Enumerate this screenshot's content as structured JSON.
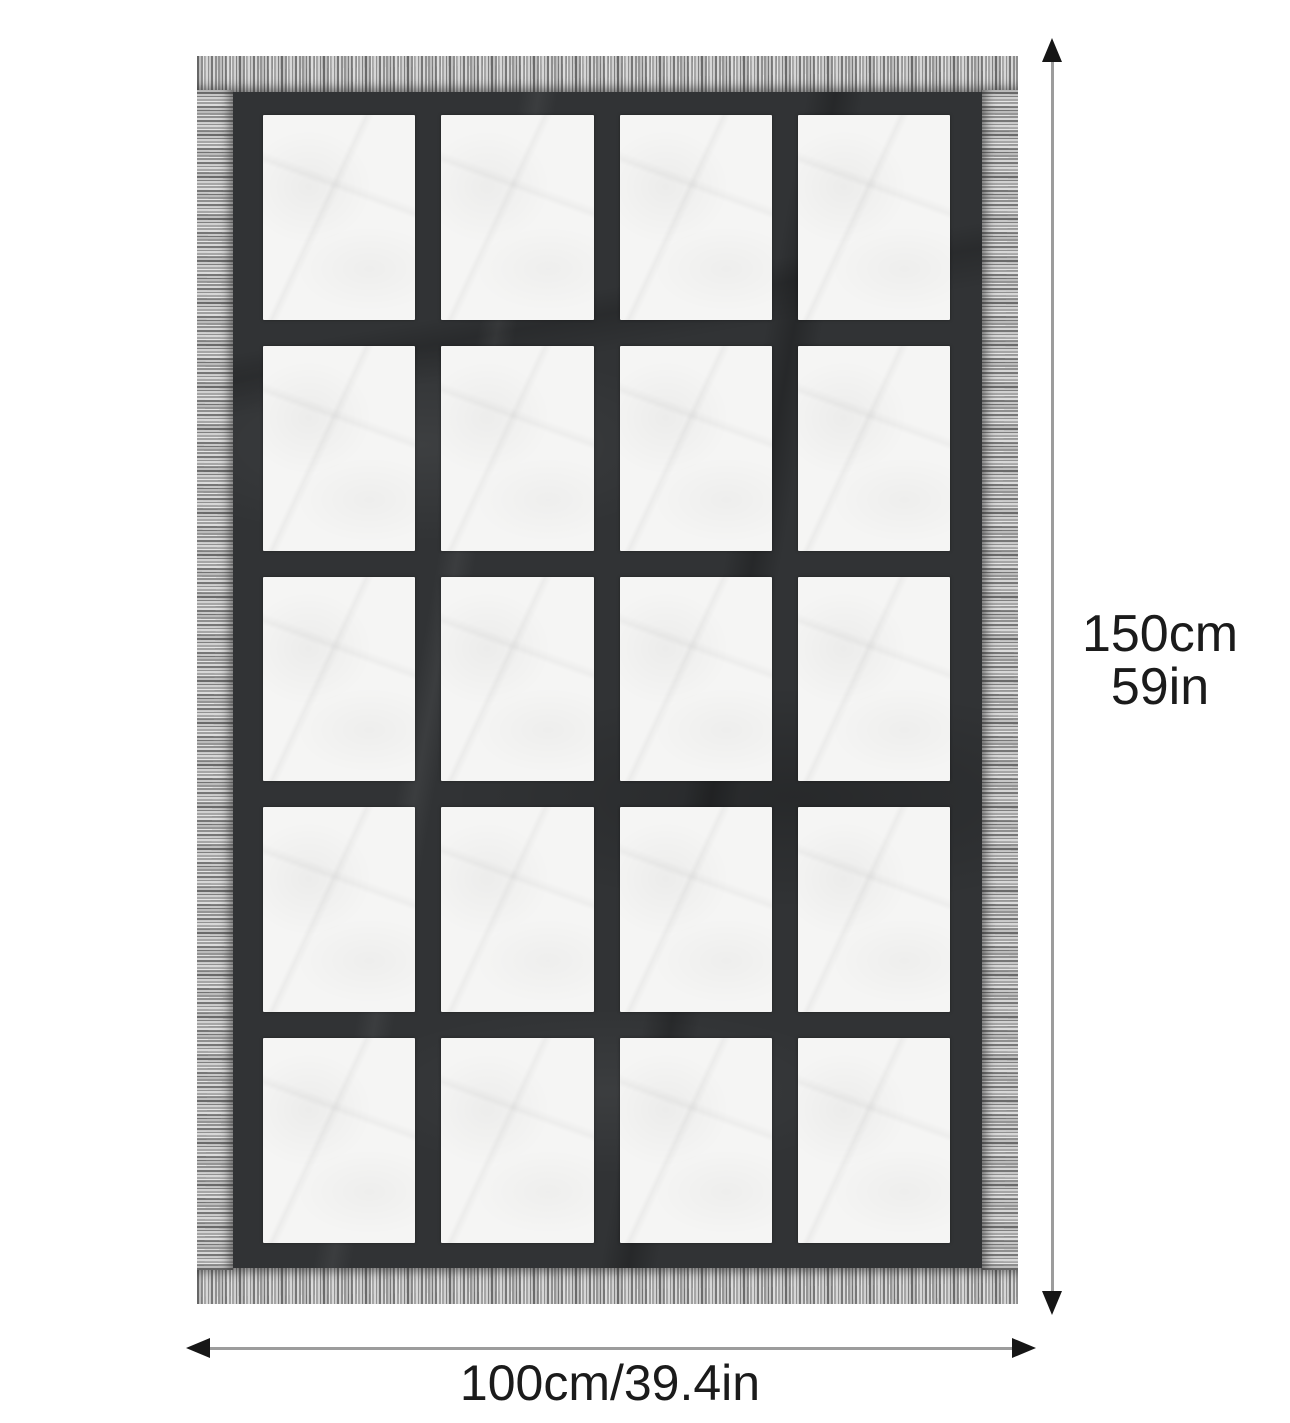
{
  "product_diagram": {
    "height_dimension": {
      "line1": "150cm",
      "line2": "59in"
    },
    "width_dimension": {
      "label": "100cm/39.4in"
    }
  },
  "blanket": {
    "rows": 5,
    "cols": 4,
    "panel_count": 20,
    "colors": {
      "body": "#313335",
      "panel": "#f5f5f4",
      "fringe_light": "#d6d6d6",
      "fringe_dark": "#767676",
      "arrow_shaft": "#9c9c9c",
      "arrow_head": "#161616",
      "text": "#1b1b1b"
    }
  }
}
